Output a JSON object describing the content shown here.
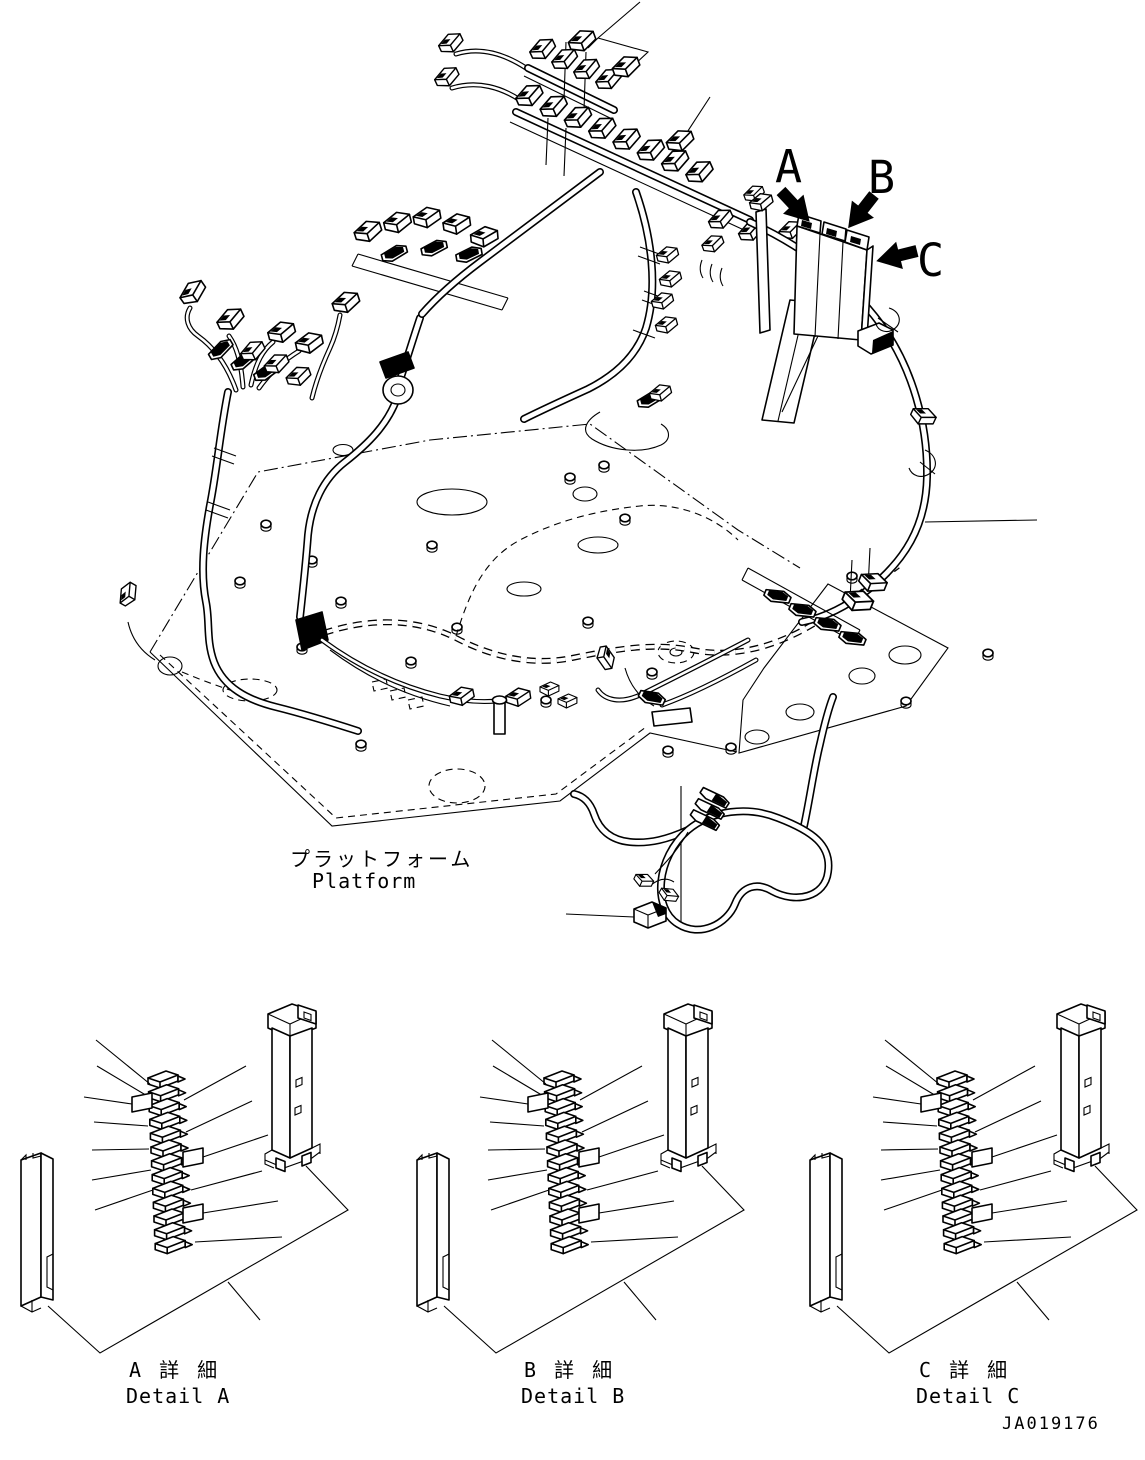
{
  "figure": {
    "type": "wiring-harness-parts-diagram",
    "colors": {
      "line": "#000000",
      "background": "#ffffff"
    },
    "drawing_number": "JA019176",
    "platform_label": {
      "jp": "プラットフォーム",
      "en": "Platform"
    },
    "callouts": [
      {
        "id": "a",
        "letter": "A"
      },
      {
        "id": "b",
        "letter": "B"
      },
      {
        "id": "c",
        "letter": "C"
      }
    ]
  },
  "details": [
    {
      "id": "a",
      "label_jp": "A 詳 細",
      "label_en": "Detail A"
    },
    {
      "id": "b",
      "label_jp": "B 詳 細",
      "label_en": "Detail B"
    },
    {
      "id": "c",
      "label_jp": "C 詳 細",
      "label_en": "Detail C"
    }
  ]
}
